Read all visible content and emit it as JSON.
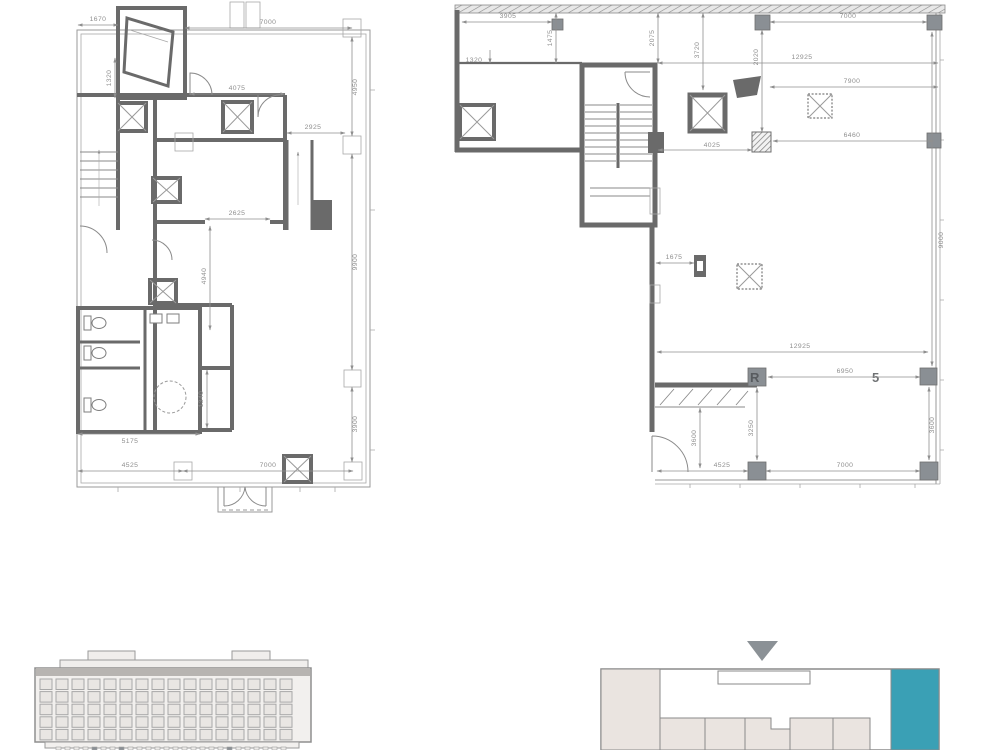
{
  "sheet": {
    "kind": "architectural-floor-plan-sheet",
    "background": "#ffffff"
  },
  "colors": {
    "wall": "#6a6a6a",
    "dim_line": "#8f8f8f",
    "dim_text": "#8f8f8f",
    "hatch": "#7a7a7a",
    "beige": "#eae4e0",
    "teal_highlight": "#3AA0B5",
    "roof_band": "#b7b4b1",
    "arrow_gray": "#8b9196"
  },
  "left_plan": {
    "label": "lower-floor-plan",
    "dims": {
      "d1670": "1670",
      "d7000_top": "7000",
      "d1320": "1320",
      "d4075": "4075",
      "d2925": "2925",
      "d2625": "2625",
      "d4940": "4940",
      "d4950": "4950",
      "d9900": "9900",
      "d3900": "3900",
      "d1340": "1340",
      "d5175": "5175",
      "d4525": "4525",
      "d7000_bottom": "7000"
    }
  },
  "right_plan": {
    "label": "upper-floor-plan",
    "dims": {
      "d3905": "3905",
      "d1320": "1320",
      "d1475": "1475",
      "d2075": "2075",
      "d3720": "3720",
      "d7000_top": "7000",
      "d2020": "2020",
      "d12925_top": "12925",
      "d7900": "7900",
      "d6460": "6460",
      "d4025": "4025",
      "d1675": "1675",
      "d9000": "9000",
      "d12925_bottom": "12925",
      "d6950": "6950",
      "d3600_left": "3600",
      "d3250": "3250",
      "d4525": "4525",
      "d7000_bottom": "7000",
      "d3600_right": "3600"
    },
    "watermark": {
      "left_char": "R",
      "right_char": "5"
    }
  },
  "elevation": {
    "label": "building-front-elevation"
  },
  "key_plan": {
    "label": "site-key-plan",
    "highlight_color": "#3AA0B5",
    "marker": "down-triangle"
  }
}
